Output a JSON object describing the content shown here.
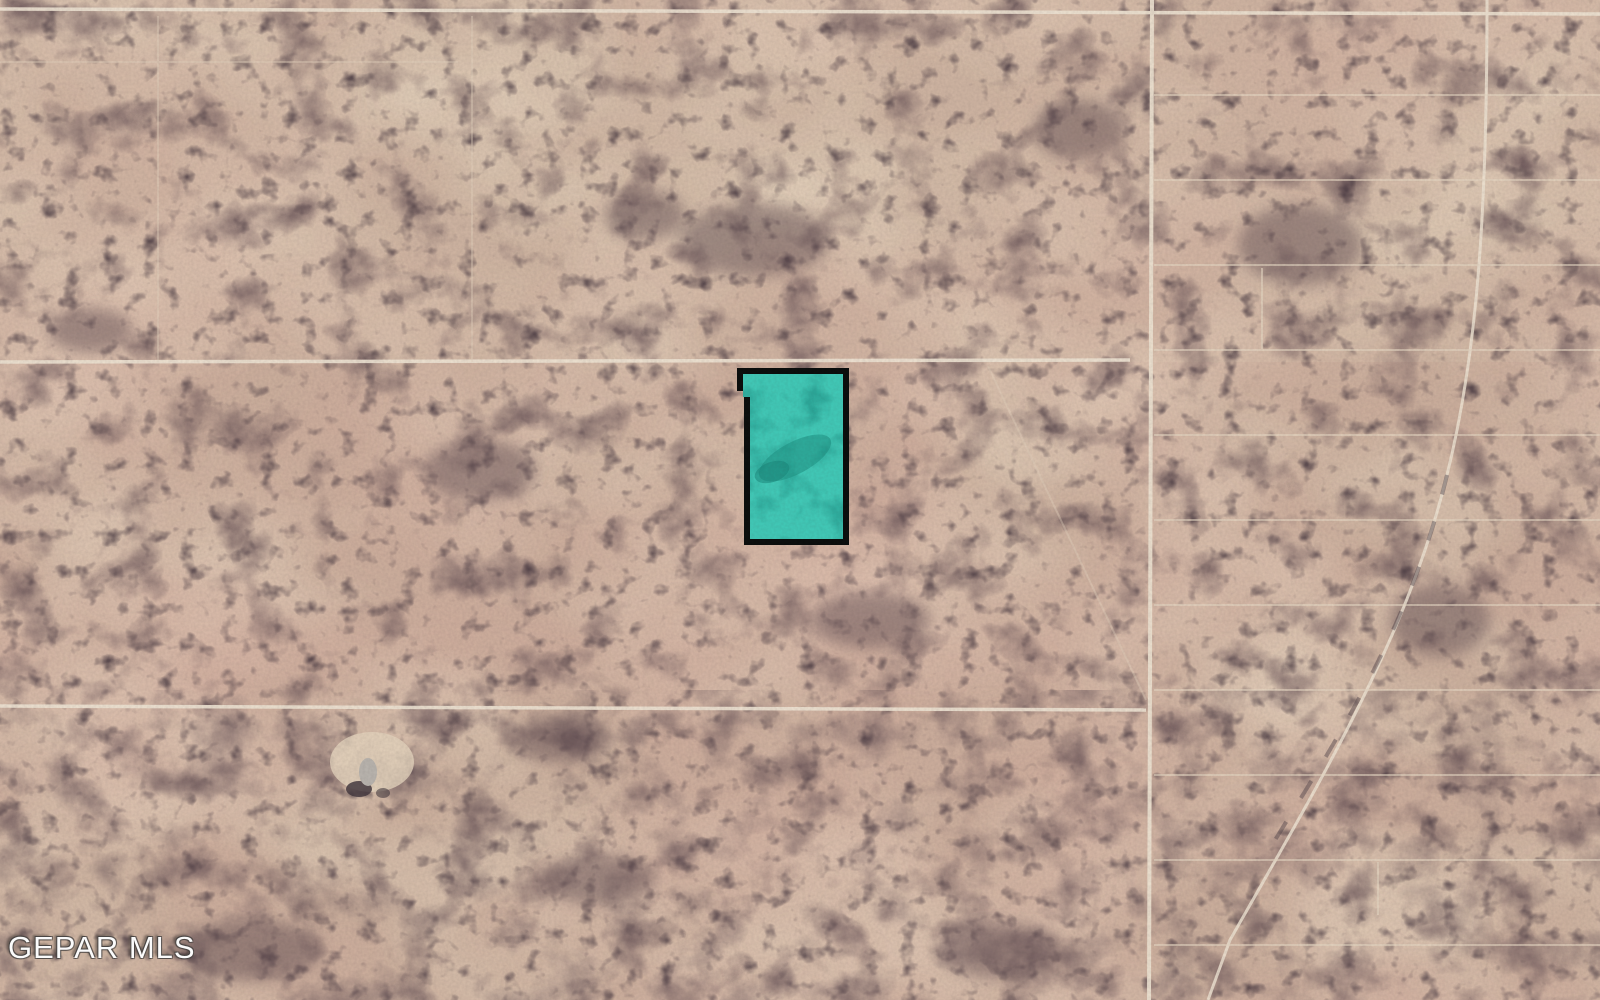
{
  "map": {
    "description": "Aerial satellite view of undeveloped desert land with a highlighted lot for sale",
    "watermark": "GEPAR MLS",
    "parcel": {
      "fill": "#41c7b5",
      "fill_dark": "#1f9488",
      "border": "#0a0d0c"
    },
    "palette": {
      "ground_base": "#c9ad9b",
      "ground_light": "#e8d8c2",
      "ground_pink": "#d4a89c",
      "scrub_dark": "#6b5659",
      "scrub_darker": "#4a3b42",
      "road_line": "#ece1d0",
      "faint_track": "#e4d6c2",
      "structure_gray": "#b7b2ac"
    }
  }
}
